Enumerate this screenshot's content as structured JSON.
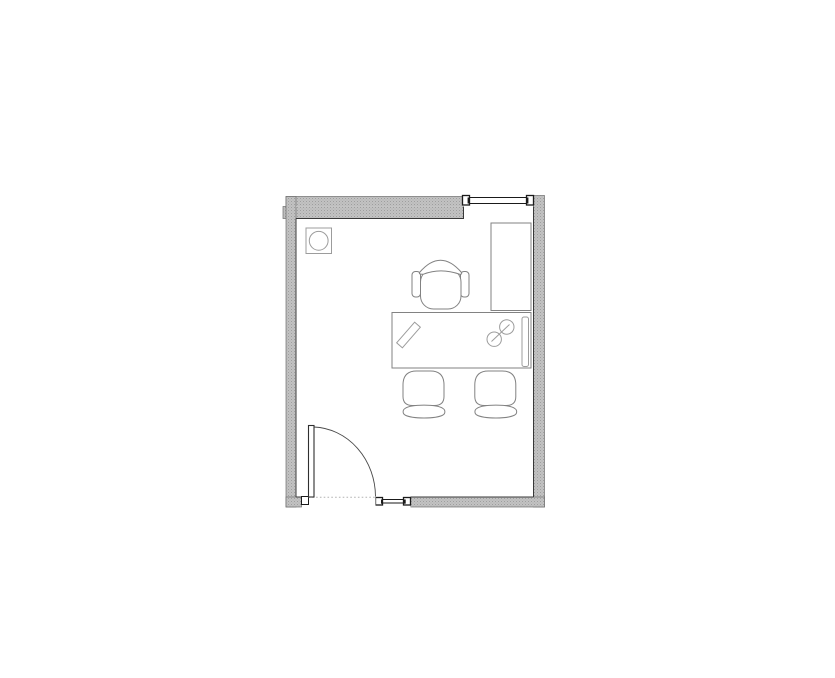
{
  "canvas": {
    "background": "#ffffff"
  },
  "floor_plan": {
    "title": "Small private office floor plan",
    "colors": {
      "background": "#ffffff",
      "wall_fill": "#c2c2c2",
      "wall_speckle": "#9e9e9e",
      "wall_speckle_light": "#aeaeae",
      "wall_edge_dark": "#383838",
      "wall_edge_light": "#6e6e6e",
      "seam": "#dcdcdc",
      "opening_frame": "#1a1a1a",
      "furniture_stroke": "#828282",
      "accessory_stroke": "#9c9c9c",
      "door_stroke": "#2f2f2f",
      "swing_arc": "#4a4a4a",
      "threshold_dots": "#b2b2b2",
      "fill_white": "#ffffff"
    },
    "elements": [
      {
        "name": "exterior-walls",
        "kind": "wall"
      },
      {
        "name": "north-window",
        "kind": "window",
        "position": "top-right"
      },
      {
        "name": "south-window",
        "kind": "window",
        "position": "bottom-center"
      },
      {
        "name": "entry-door",
        "kind": "door",
        "swing": "inward, hinged bottom-left"
      },
      {
        "name": "waste-bin",
        "kind": "accessory",
        "position": "top-left corner"
      },
      {
        "name": "storage-cabinet",
        "kind": "furniture",
        "position": "right wall above desk"
      },
      {
        "name": "desk",
        "kind": "furniture",
        "position": "center-right"
      },
      {
        "name": "desk-return-panel",
        "kind": "furniture",
        "position": "right edge of desk"
      },
      {
        "name": "pencil",
        "kind": "desk-item",
        "position": "left side of desk"
      },
      {
        "name": "phone-handset",
        "kind": "desk-item",
        "position": "right side of desk"
      },
      {
        "name": "task-chair",
        "kind": "furniture",
        "position": "above desk"
      },
      {
        "name": "guest-chair-left",
        "kind": "furniture",
        "position": "below desk"
      },
      {
        "name": "guest-chair-right",
        "kind": "furniture",
        "position": "below desk"
      }
    ]
  }
}
